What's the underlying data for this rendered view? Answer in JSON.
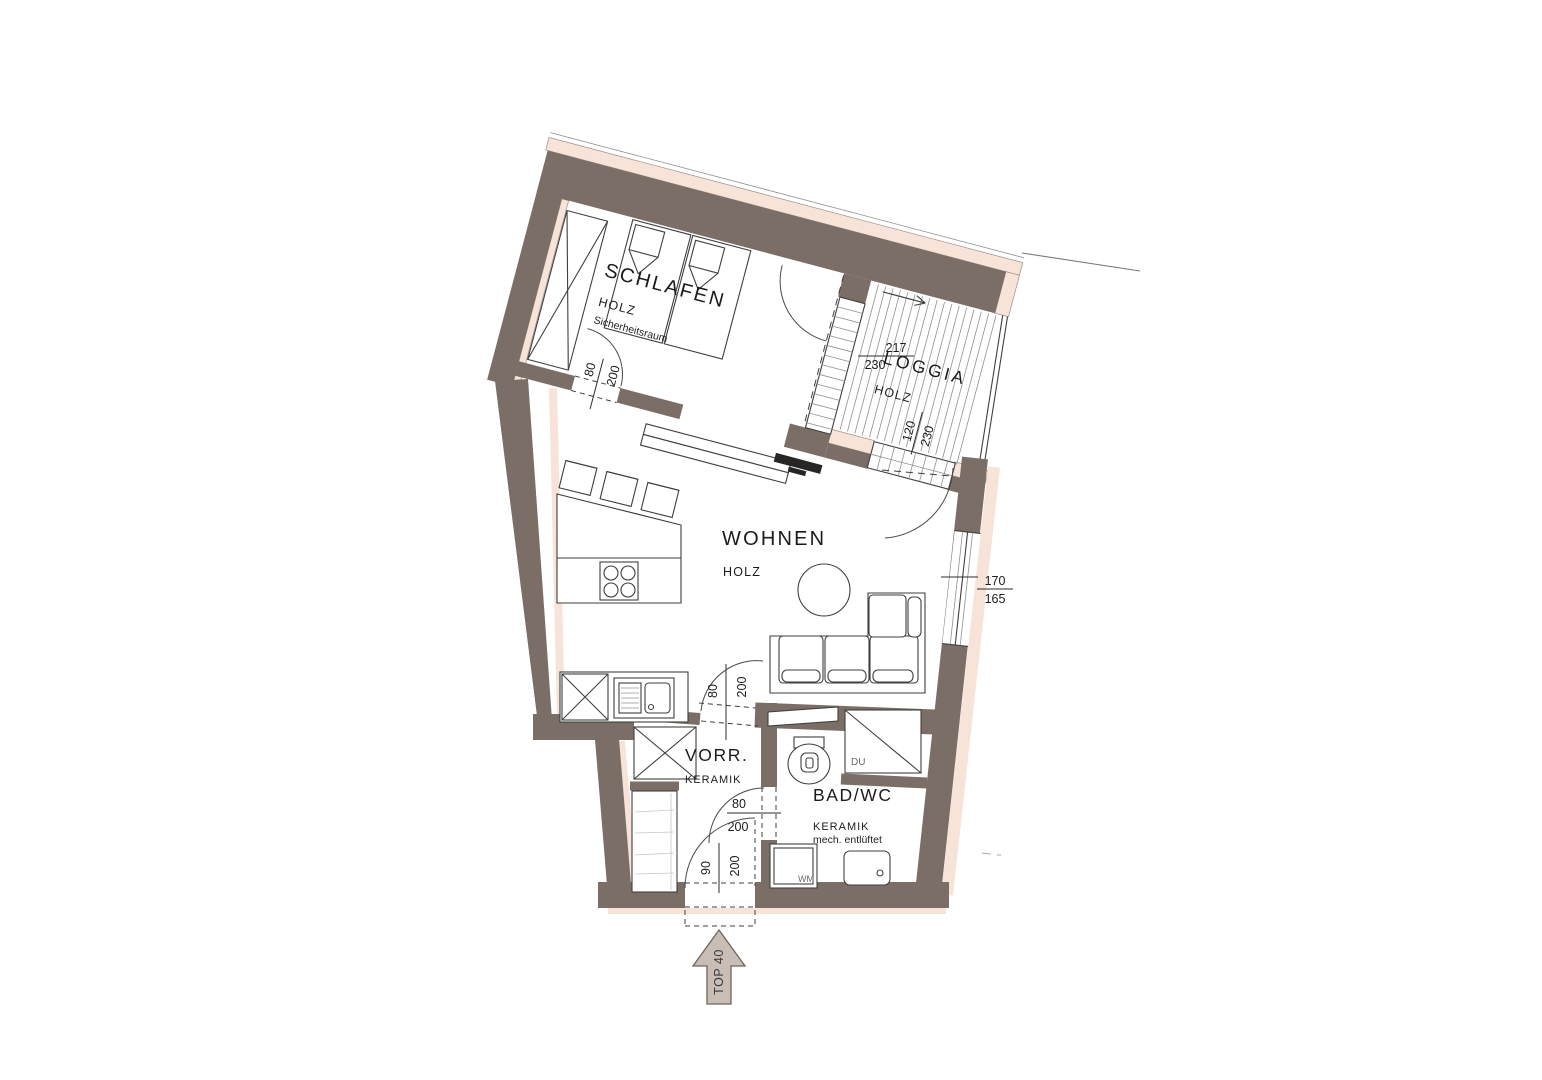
{
  "plan": {
    "unit_label": "TOP 40",
    "rooms": {
      "schlafen": {
        "name": "SCHLAFEN",
        "material": "HOLZ",
        "note": "Sicherheitsraum"
      },
      "loggia": {
        "name": "LOGGIA",
        "material": "HOLZ"
      },
      "wohnen": {
        "name": "WOHNEN",
        "material": "HOLZ"
      },
      "vorraum": {
        "name": "VORR.",
        "material": "KERAMIK"
      },
      "bad": {
        "name": "BAD/WC",
        "material": "KERAMIK",
        "note": "mech. entlüftet"
      }
    },
    "fixtures": {
      "shower": "DU",
      "washing_machine": "WM"
    },
    "dimensions": {
      "schlafen_door": {
        "width": "80",
        "height": "200"
      },
      "loggia_sliding_door": {
        "width": "217",
        "height": "230"
      },
      "loggia_door": {
        "width": "120",
        "height": "230"
      },
      "living_window": {
        "width": "170",
        "height": "165"
      },
      "vorraum_door": {
        "width": "80",
        "height": "200"
      },
      "bad_door": {
        "width": "80",
        "height": "200"
      },
      "entrance_door": {
        "width": "90",
        "height": "200"
      }
    },
    "colors": {
      "wall": "#7b6e67",
      "insulation": "#f7e3d7",
      "arrow_fill": "#c9beb5",
      "line": "#3f3f3f"
    }
  }
}
